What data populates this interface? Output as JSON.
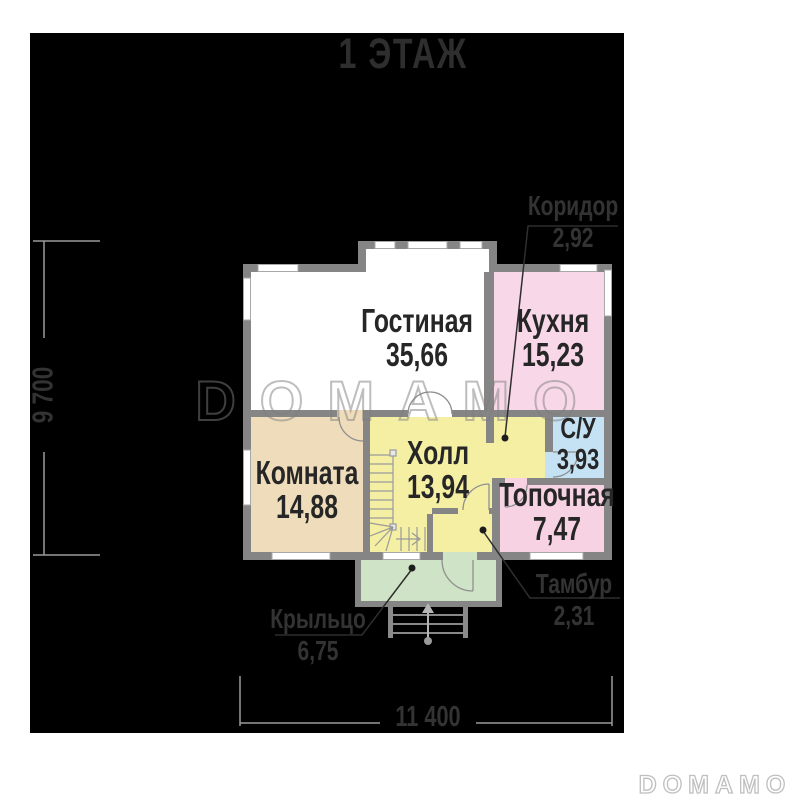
{
  "title": "1 ЭТАЖ",
  "rooms": [
    {
      "name": "Гостиная",
      "area": "35,66"
    },
    {
      "name": "Кухня",
      "area": "15,23"
    },
    {
      "name": "Комната",
      "area": "14,88"
    },
    {
      "name": "Холл",
      "area": "13,94"
    },
    {
      "name": "С/У",
      "area": "3,93"
    },
    {
      "name": "Топочная",
      "area": "7,47"
    }
  ],
  "callouts": [
    {
      "name": "Коридор",
      "area": "2,92"
    },
    {
      "name": "Тамбур",
      "area": "2,31"
    },
    {
      "name": "Крыльцо",
      "area": "6,75"
    }
  ],
  "dimensions": {
    "width": "11 400",
    "height": "9 700"
  },
  "watermarks": {
    "center": "DOMAMO",
    "footer": "DOMAMO"
  },
  "colors": {
    "background": "#000000",
    "wall": "#858585",
    "living": "#ffffff",
    "kitchen": "#f8d8e8",
    "boiler": "#f7d2e2",
    "wc": "#c4e2f3",
    "hall": "#f5efa4",
    "room": "#efdcbb",
    "porch": "#cfe4c6",
    "label_dark": "#262626",
    "dimension_line": "#9b9b9b"
  }
}
